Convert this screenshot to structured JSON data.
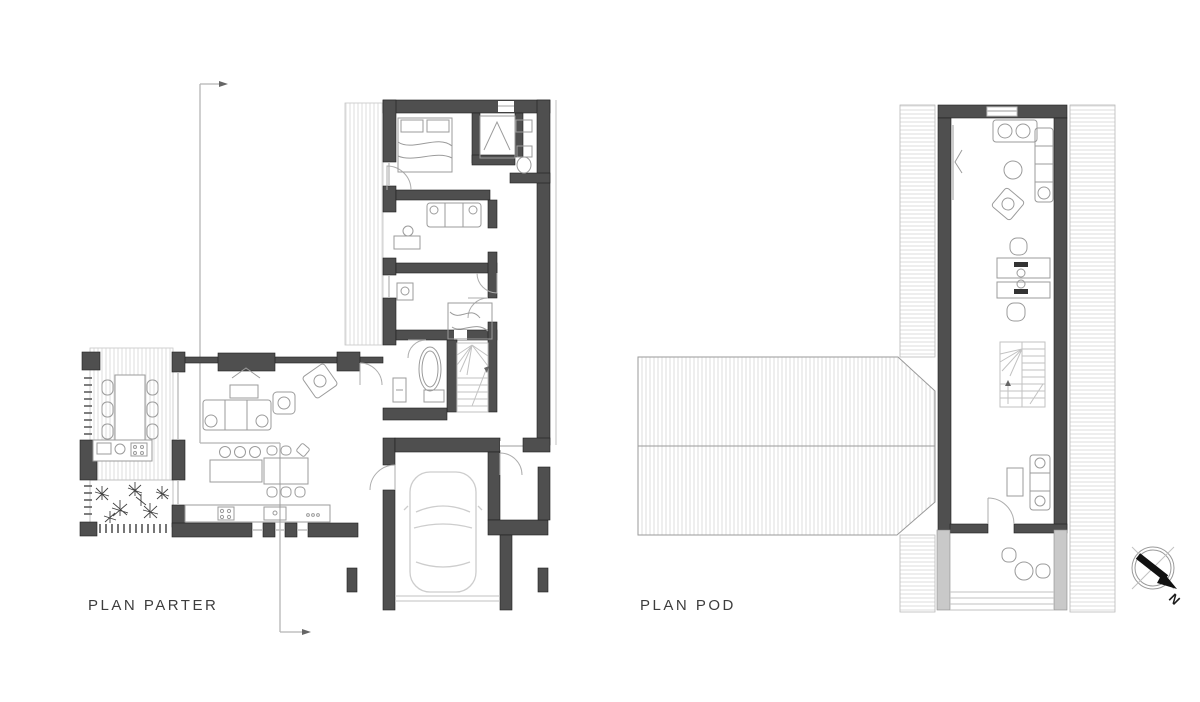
{
  "title": "House floor plans",
  "plans": [
    {
      "name": "PLAN PARTER",
      "position": "left",
      "features": [
        "side-terrace-hatch",
        "double-bed",
        "wardrobe",
        "wc-toilet-sink",
        "study-sofa",
        "desk",
        "kids-bed",
        "bathtub",
        "washbasin",
        "winder-stairs",
        "fireplace",
        "living-sofa",
        "coffee-table",
        "armchairs",
        "kitchen-island",
        "bar-stools",
        "dining-table",
        "kitchen-counter",
        "outdoor-dining-table",
        "outdoor-kitchen-counter",
        "planting-bed",
        "deck-board-ticks",
        "garage-car",
        "garage-door",
        "carport-pillars",
        "section-cut-arrows"
      ]
    },
    {
      "name": "PLAN POD",
      "position": "right",
      "features": [
        "hipped-roof-hatch",
        "ridge-line",
        "eaves-strip-hatch",
        "chimney-opening",
        "corner-sofa",
        "round-table",
        "rotated-armchair",
        "twin-desks",
        "desk-chairs",
        "u-winder-stairs",
        "tv-sofa",
        "coffee-table",
        "interior-door",
        "balcony-round-table",
        "balcony-chairs",
        "terrace-steps"
      ]
    }
  ],
  "compass": {
    "letter": "N",
    "direction": "south-east-pointing-needle"
  },
  "colors": {
    "background": "#ffffff",
    "wall": "#4f4f4f",
    "wall-light": "#c9c9c9",
    "hatch": "#dedede",
    "furniture": "#9b9b9b",
    "car": "#cdcdcd",
    "label-text": "#3d3d3d",
    "section-line": "#b5b5b5",
    "needle": "#111111"
  }
}
